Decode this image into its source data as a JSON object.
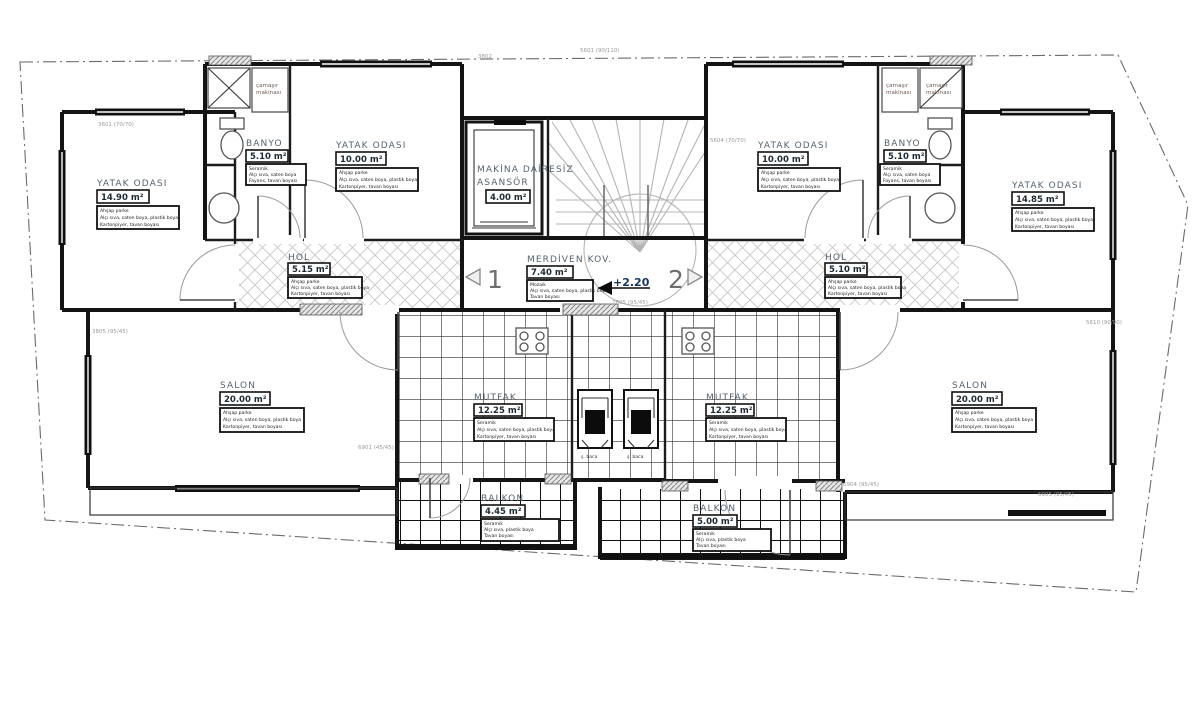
{
  "drawing": {
    "type": "architectural floor plan",
    "language": "Turkish",
    "floor_level_mark": "+2.20"
  },
  "colors": {
    "line": "#141414",
    "room_name_text": "#55636e",
    "level_text": "#17365d",
    "hatch": "#c6c6c6",
    "stair": "#b4b4b4",
    "dim_text": "#9a9a9a"
  },
  "rooms": [
    {
      "name": "YATAK ODASI",
      "area": "14.90 m²",
      "notes": [
        "Ahşap parke",
        "Alçı sıva, saten boya, plastik boya",
        "Kartonpiyer, tavan boyası"
      ]
    },
    {
      "name": "BANYO",
      "area": "5.10 m²",
      "notes": [
        "Seramik",
        "Alçı sıva, saten boya",
        "Fayans, tavan boyası"
      ]
    },
    {
      "name": "YATAK ODASI",
      "area": "10.00 m²",
      "notes": [
        "Ahşap parke",
        "Alçı sıva, saten boya, plastik boya",
        "Kartonpiyer, tavan boyası"
      ]
    },
    {
      "name": "MAKİNA DAİRESİZ",
      "name2": "ASANSÖR",
      "area": "4.00 m²",
      "notes": []
    },
    {
      "name": "MERDİVEN KOV.",
      "area": "7.40 m²",
      "notes": [
        "Mozaik",
        "Alçı sıva, saten boya, plastik boya",
        "Tavan boyası"
      ]
    },
    {
      "name": "HOL",
      "area": "5.15 m²",
      "notes": [
        "Ahşap parke",
        "Alçı sıva, saten boya, plastik boya",
        "Kartonpiyer, tavan boyası"
      ]
    },
    {
      "name": "HOL",
      "area": "5.10 m²",
      "notes": [
        "Ahşap parke",
        "Alçı sıva, saten boya, plastik boya",
        "Kartonpiyer, tavan boyası"
      ]
    },
    {
      "name": "YATAK ODASI",
      "area": "10.00 m²",
      "notes": [
        "Ahşap parke",
        "Alçı sıva, saten boya, plastik boya",
        "Kartonpiyer, tavan boyası"
      ]
    },
    {
      "name": "BANYO",
      "area": "5.10 m²",
      "notes": [
        "Seramik",
        "Alçı sıva, saten boya",
        "Fayans, tavan boyası"
      ]
    },
    {
      "name": "YATAK ODASI",
      "area": "14.85 m²",
      "notes": [
        "Ahşap parke",
        "Alçı sıva, saten boya, plastik boya",
        "Kartonpiyer, tavan boyası"
      ]
    },
    {
      "name": "SALON",
      "area": "20.00 m²",
      "notes": [
        "Ahşap parke",
        "Alçı sıva, saten boya, plastik boya",
        "Kartonpiyer, tavan boyası"
      ]
    },
    {
      "name": "MUTFAK",
      "area": "12.25 m²",
      "notes": [
        "Seramik",
        "Alçı sıva, saten boya, plastik boya",
        "Kartonpiyer, tavan boyası"
      ]
    },
    {
      "name": "MUTFAK",
      "area": "12.25 m²",
      "notes": [
        "Seramik",
        "Alçı sıva, saten boya, plastik boya",
        "Kartonpiyer, tavan boyası"
      ]
    },
    {
      "name": "SALON",
      "area": "20.00 m²",
      "notes": [
        "Ahşap parke",
        "Alçı sıva, saten boya, plastik boya",
        "Kartonpiyer, tavan boyası"
      ]
    },
    {
      "name": "BALKON",
      "area": "4.45 m²",
      "notes": [
        "Seramik",
        "Alçı sıva, plastik boya",
        "Tavan boyası"
      ]
    },
    {
      "name": "BALKON",
      "area": "5.00 m²",
      "notes": [
        "Seramik",
        "Alçı sıva, plastik boya",
        "Tavan boyası"
      ]
    }
  ],
  "markers": {
    "unit_left": "1",
    "unit_right": "2",
    "level": "+2.20"
  },
  "equipment": {
    "washer_line1": "çamaşır",
    "washer_line2": "makinası",
    "chimney": "ş. baca"
  },
  "dims": [
    "3601 (70/70)",
    "3802",
    "5601 (90/110)",
    "5604 (70/70)",
    "3805 (95/45)",
    "2805 (95/45)",
    "6901 (45/45)",
    "6904 (95/45)",
    "6905 (95/45)",
    "5610 (90/90)"
  ]
}
